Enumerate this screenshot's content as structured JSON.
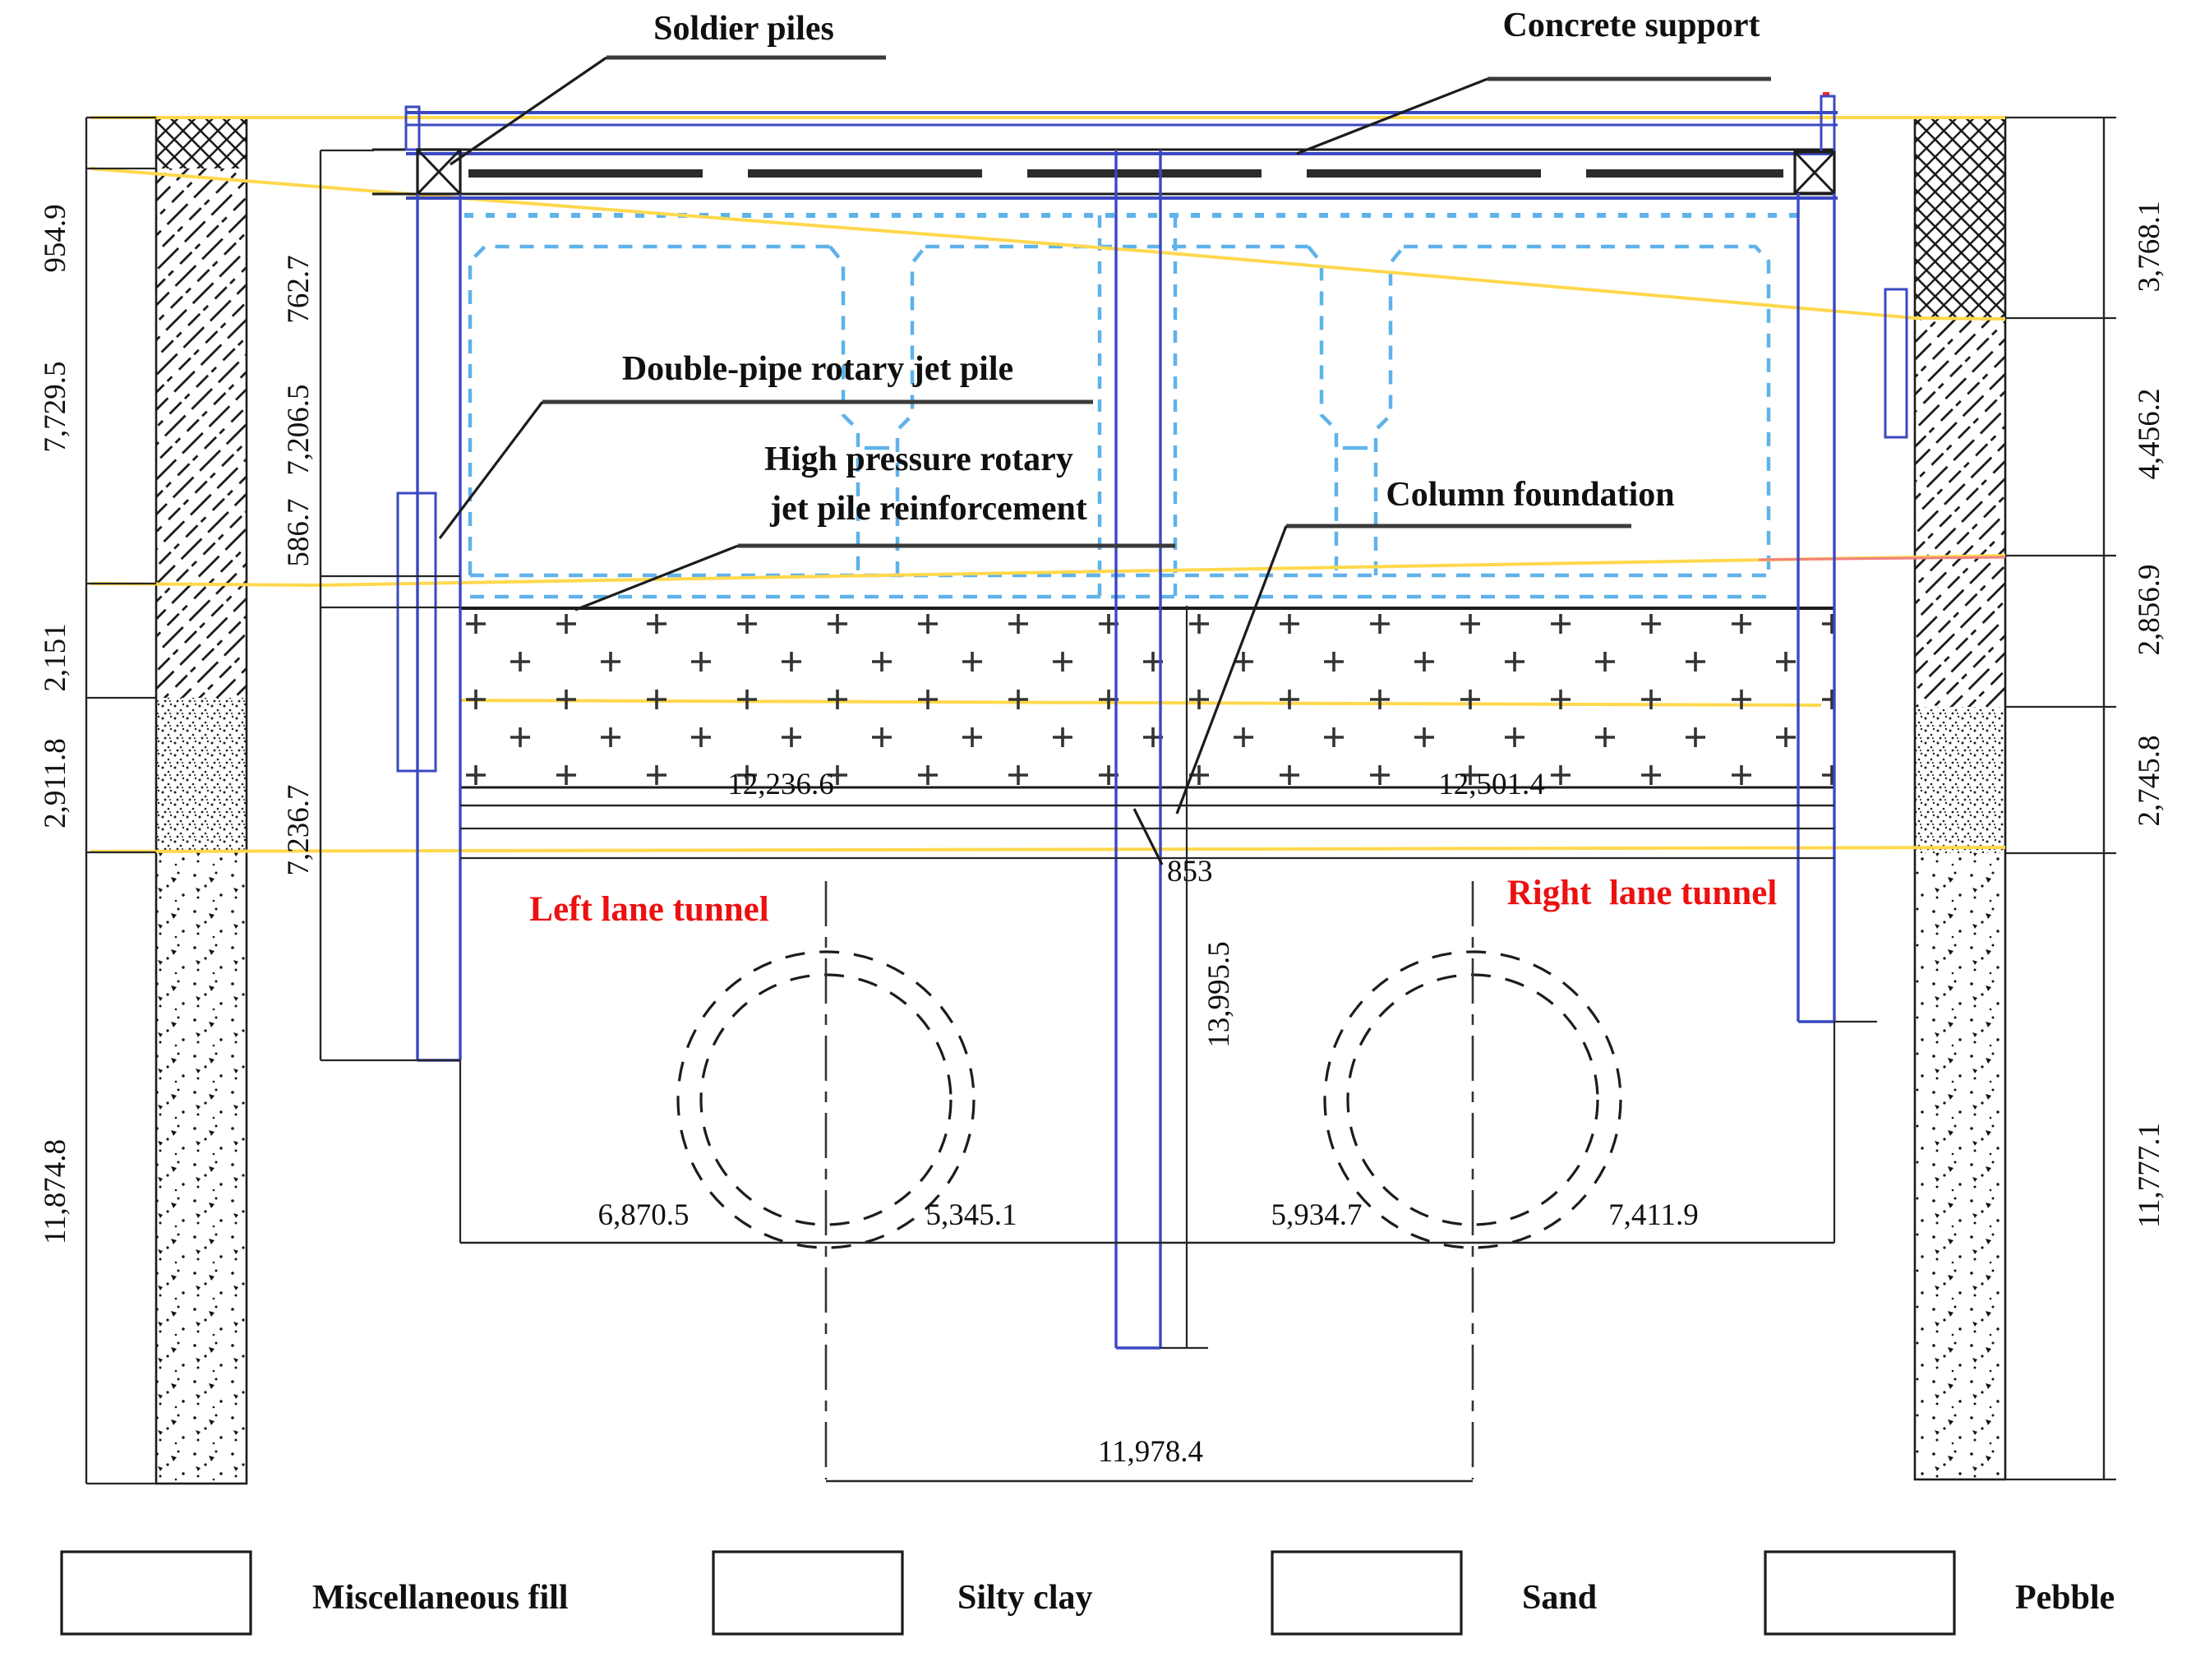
{
  "drawing_title": "Tunnel excavation cross-section with soil strata and support system",
  "labels": {
    "soldier_piles": "Soldier piles",
    "concrete_support": "Concrete support",
    "double_pipe": "Double-pipe rotary jet pile",
    "high_pressure_1": "High pressure rotary",
    "high_pressure_2": "jet pile reinforcement",
    "column_foundation": "Column foundation",
    "left_tunnel": "Left lane tunnel",
    "right_tunnel": "Right  lane tunnel"
  },
  "dims": {
    "left_outer": [
      "954.9",
      "7,729.5",
      "2,151",
      "2,911.8",
      "11,874.8"
    ],
    "left_inner": [
      "762.7",
      "7,206.5",
      "586.7",
      "7,236.7"
    ],
    "right_outer": [
      "3,768.1",
      "4,456.2",
      "2,856.9",
      "2,745.8",
      "11,777.1"
    ],
    "top_span_left": "12,236.6",
    "top_span_right": "12,501.4",
    "column_width": "853",
    "column_depth": "13,995.5",
    "bottom_spans": [
      "6,870.5",
      "5,345.1",
      "5,934.7",
      "7,411.9"
    ],
    "tunnel_spacing": "11,978.4"
  },
  "legend": [
    {
      "id": "miscellaneous-fill",
      "label": "Miscellaneous fill"
    },
    {
      "id": "silty-clay",
      "label": "Silty clay"
    },
    {
      "id": "sand",
      "label": "Sand"
    },
    {
      "id": "pebble",
      "label": "Pebble"
    }
  ],
  "colors": {
    "structure_blue": "#3a49c2",
    "jet_pile_dashed_blue": "#5fb2ea",
    "stratum_yellow": "#ffd84d",
    "stratum_red": "#f28080",
    "tunnel_label_red": "#ec1111",
    "pile_cap_red": "#ff2222"
  }
}
